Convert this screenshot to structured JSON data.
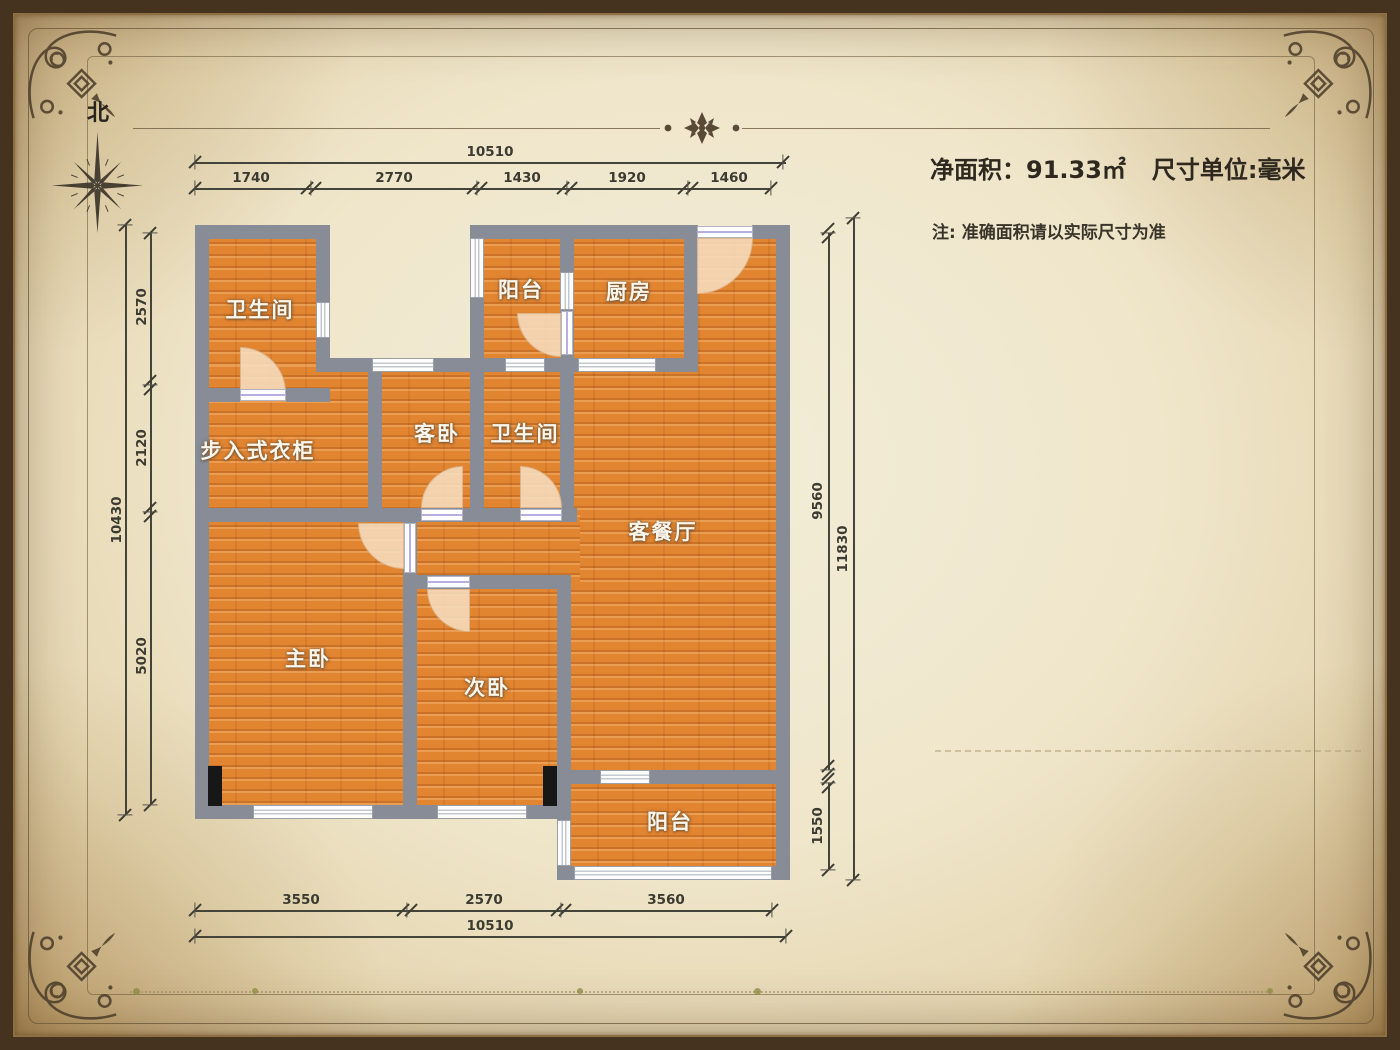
{
  "compass": {
    "north": "北"
  },
  "info": {
    "area_label": "净面积：",
    "area_value": "91.33㎡",
    "unit_text": "尺寸单位:毫米",
    "note": "注: 准确面积请以实际尺寸为准"
  },
  "rooms": [
    {
      "id": "bathroom-1",
      "label": "卫生间"
    },
    {
      "id": "balcony-top",
      "label": "阳台"
    },
    {
      "id": "kitchen",
      "label": "厨房"
    },
    {
      "id": "walkin-closet",
      "label": "步入式衣柜"
    },
    {
      "id": "guest-bedroom",
      "label": "客卧"
    },
    {
      "id": "bathroom-2",
      "label": "卫生间"
    },
    {
      "id": "living-dining",
      "label": "客餐厅"
    },
    {
      "id": "master-bedroom",
      "label": "主卧"
    },
    {
      "id": "second-bedroom",
      "label": "次卧"
    },
    {
      "id": "balcony-bottom",
      "label": "阳台"
    }
  ],
  "dimensions": {
    "top": {
      "total": "10510",
      "segments": [
        "1740",
        "2770",
        "1430",
        "1920",
        "1460"
      ]
    },
    "left": {
      "total": "10430",
      "segments": [
        "2570",
        "2120",
        "5020"
      ]
    },
    "right": {
      "upper": "9560",
      "total": "11830",
      "balcony": "1550"
    },
    "bottom": {
      "total": "10510",
      "segments": [
        "3550",
        "2570",
        "3560"
      ]
    }
  },
  "colors": {
    "wall": "#878c96",
    "floor": "#e28531",
    "parchment": "#efe6cb",
    "ink": "#3c3b31",
    "ornament": "#4a3b28"
  }
}
